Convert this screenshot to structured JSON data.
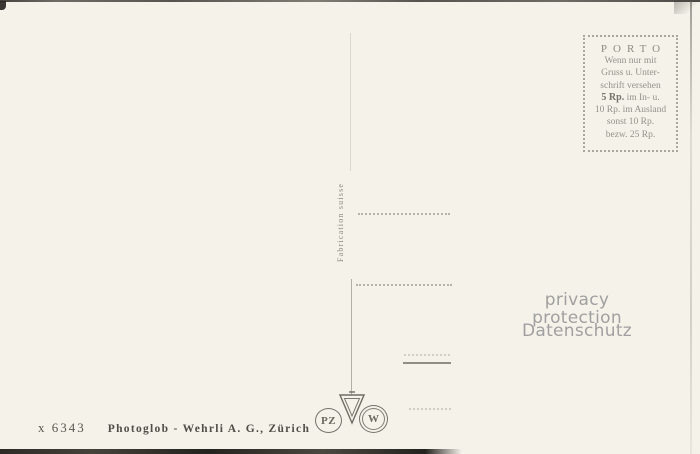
{
  "card": {
    "type": "postcard-back",
    "background_color": "#f5f2ea",
    "ink_color": "#8d8b81",
    "imprint_ink_color": "#504e46"
  },
  "stamp_box": {
    "title": "PORTO",
    "lines": [
      "Wenn nur mit",
      "Gruss u. Unter-",
      "schrift versehen"
    ],
    "rate_bold": "5 Rp.",
    "rate_rest": " im In- u.",
    "lines2": [
      "10 Rp. im Ausland",
      "sonst 10 Rp.",
      "bezw. 25 Rp."
    ]
  },
  "divider": {
    "label": "Fabrication suisse"
  },
  "watermark": {
    "line1": "privacy protection",
    "line2": "Datenschutz"
  },
  "logos": {
    "pz_letters": "PZ",
    "w_letter": "W",
    "v_mark": "inverted-triangle-trademark"
  },
  "imprint": {
    "number": "x 6343",
    "publisher": "Photoglob - Wehrli A. G., Zürich"
  }
}
